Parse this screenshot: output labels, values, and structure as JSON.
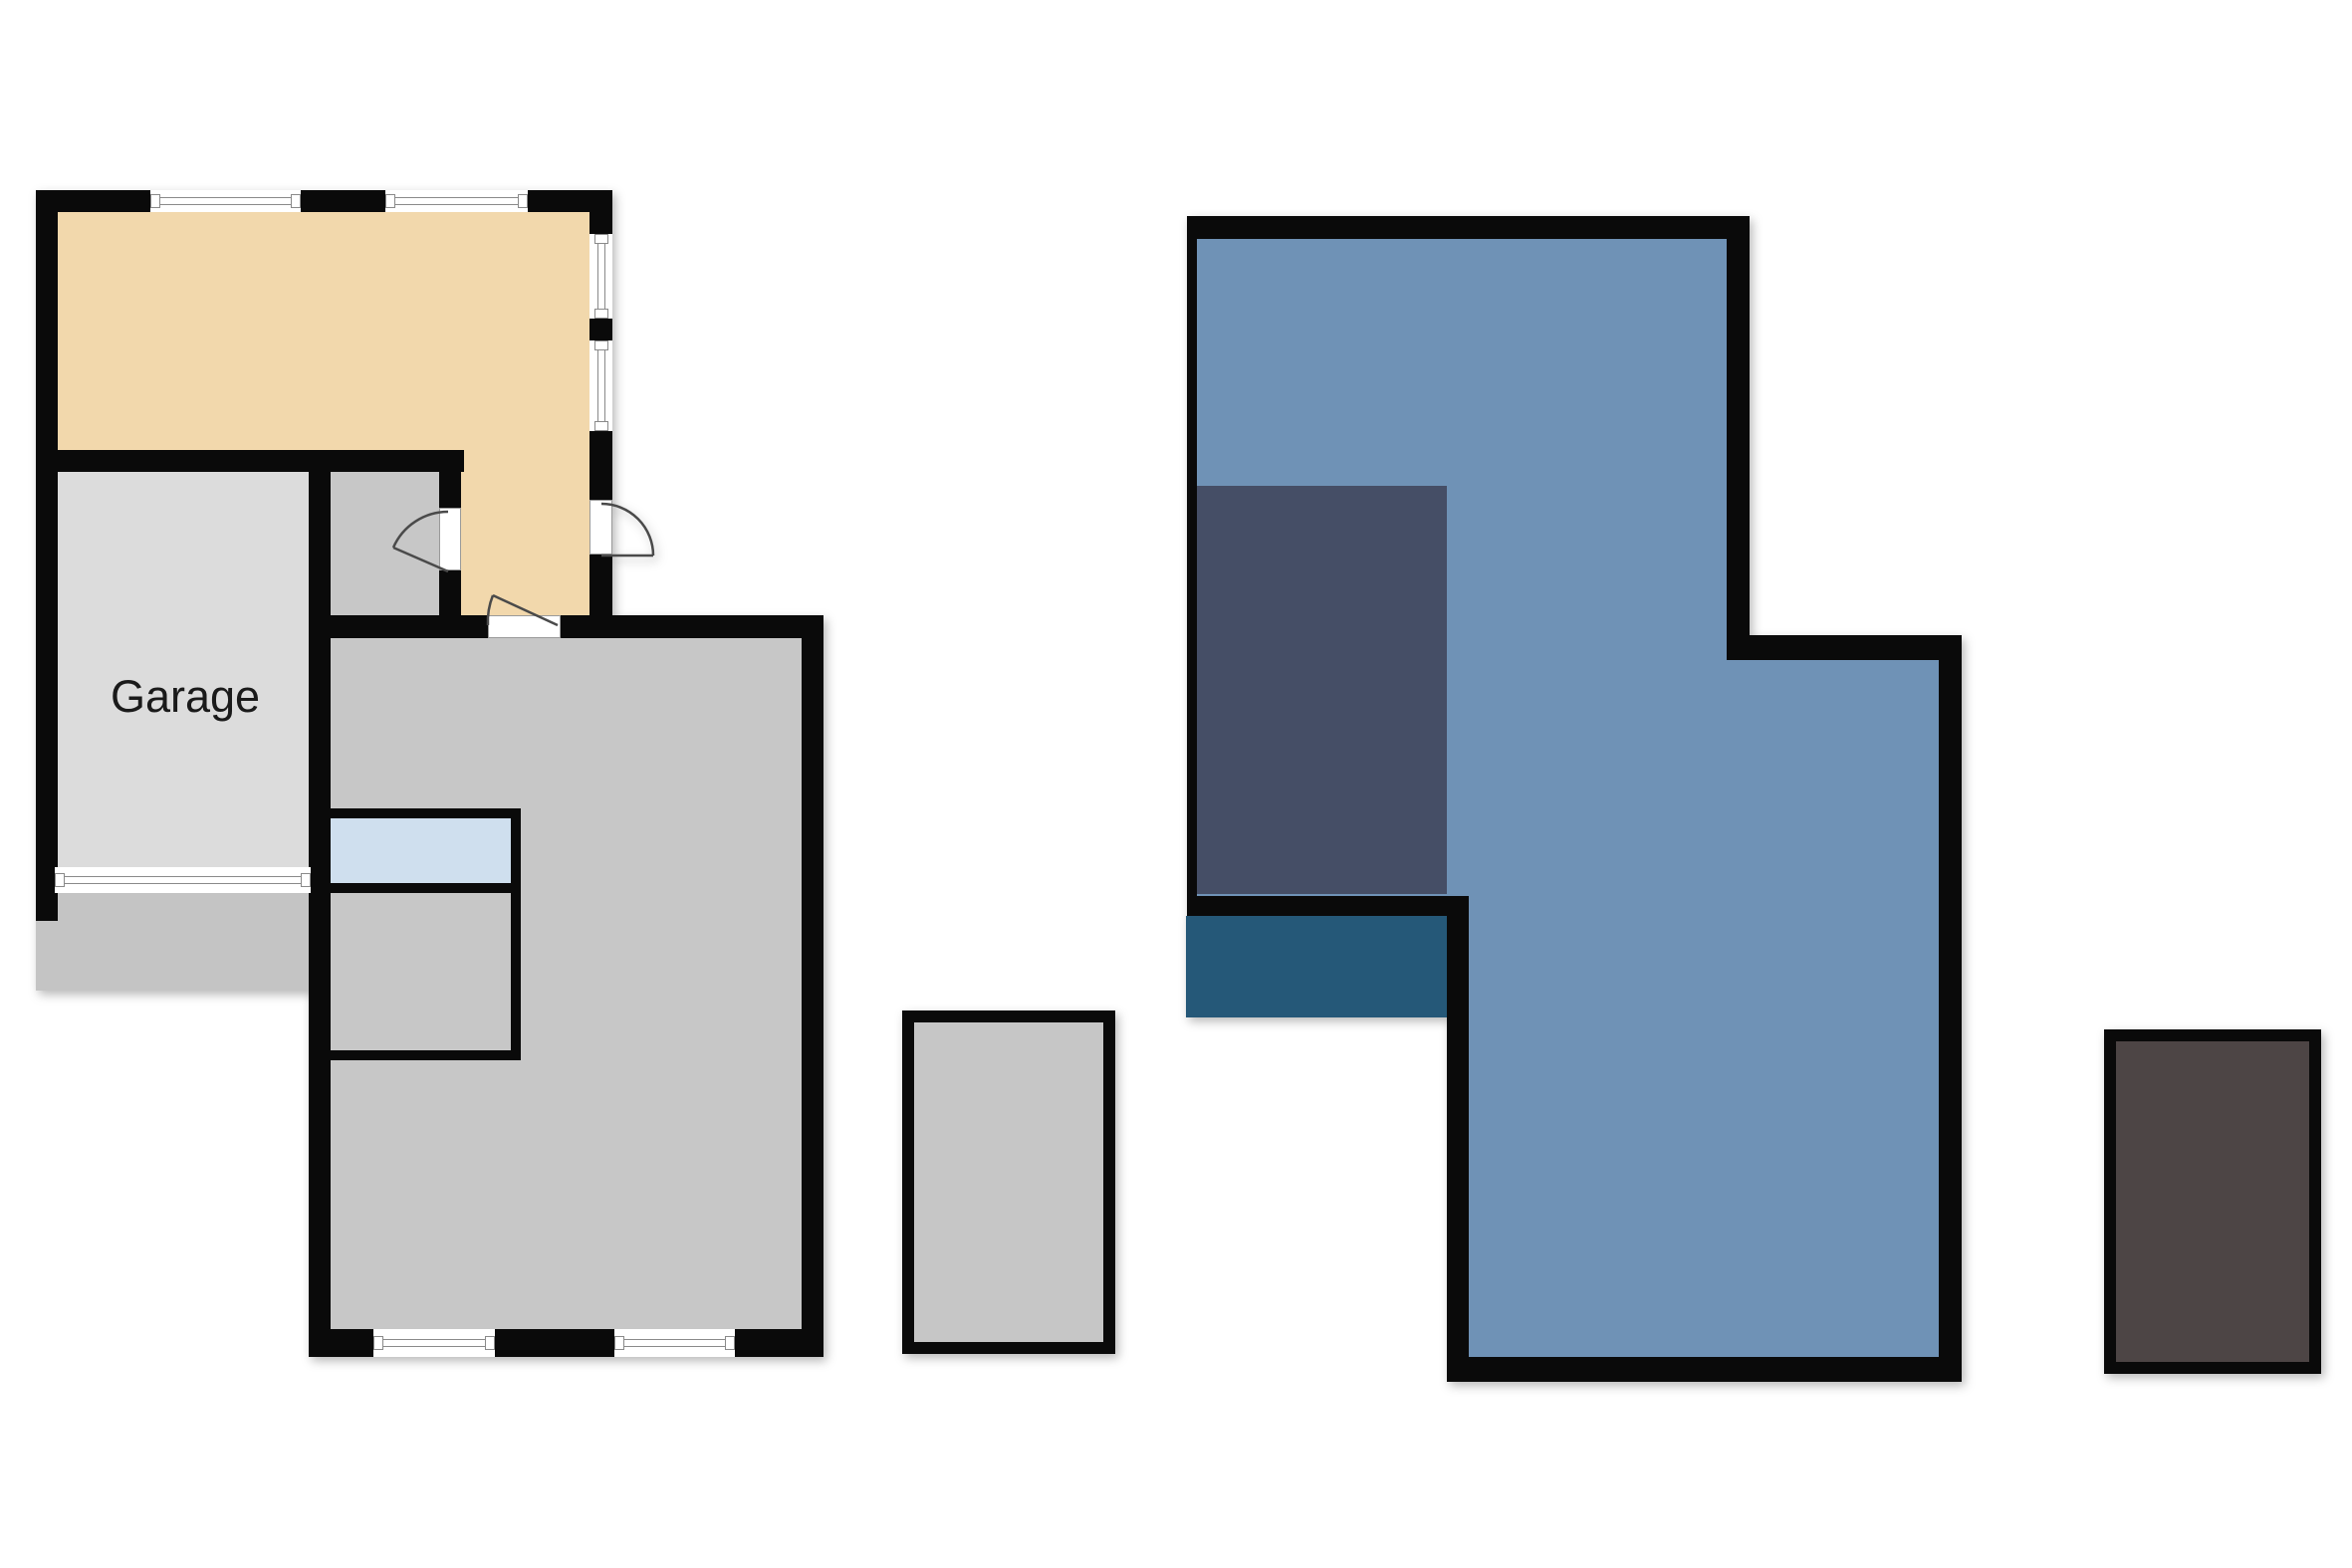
{
  "page": {
    "background": "#ffffff"
  },
  "colors": {
    "wall": "#0a0a0a",
    "tan_room": "#F2D8AC",
    "garage_gray": "#DCDCDC",
    "room_gray": "#C7C7C7",
    "driveway_gray": "#C4C4C4",
    "light_blue": "#CFDFEE",
    "plan_blue": "#6F92B6",
    "slate_blue": "#454E66",
    "teal_blue": "#255878",
    "brown": "#4D4545",
    "outbuilding_gray": "#C6C6C6",
    "window_frame": "#8a8a8a"
  },
  "left_plan": {
    "name": "ground-floor-plan",
    "garage_label": "Garage",
    "rooms": [
      {
        "id": "living-area",
        "label": "",
        "fill": "#F2D8AC"
      },
      {
        "id": "garage",
        "label": "Garage",
        "fill": "#DCDCDC"
      },
      {
        "id": "hall",
        "label": "",
        "fill": "#C7C7C7"
      },
      {
        "id": "main-room",
        "label": "",
        "fill": "#C7C7C7"
      },
      {
        "id": "stair-landing",
        "label": "",
        "fill": "#CFDFEE"
      },
      {
        "id": "inner-room",
        "label": "",
        "fill": "#C7C7C7"
      },
      {
        "id": "driveway",
        "label": "",
        "fill": "#C4C4C4"
      }
    ],
    "window_count": 6,
    "door_count": 3
  },
  "right_plan": {
    "name": "upper-floor-plan",
    "rooms": [
      {
        "id": "main-area",
        "label": "",
        "fill": "#6F92B6"
      },
      {
        "id": "side-room",
        "label": "",
        "fill": "#454E66"
      },
      {
        "id": "balcony",
        "label": "",
        "fill": "#255878"
      }
    ]
  },
  "outbuildings": [
    {
      "id": "shed-gray",
      "label": "",
      "fill": "#C6C6C6"
    },
    {
      "id": "shed-brown",
      "label": "",
      "fill": "#4D4545"
    }
  ]
}
